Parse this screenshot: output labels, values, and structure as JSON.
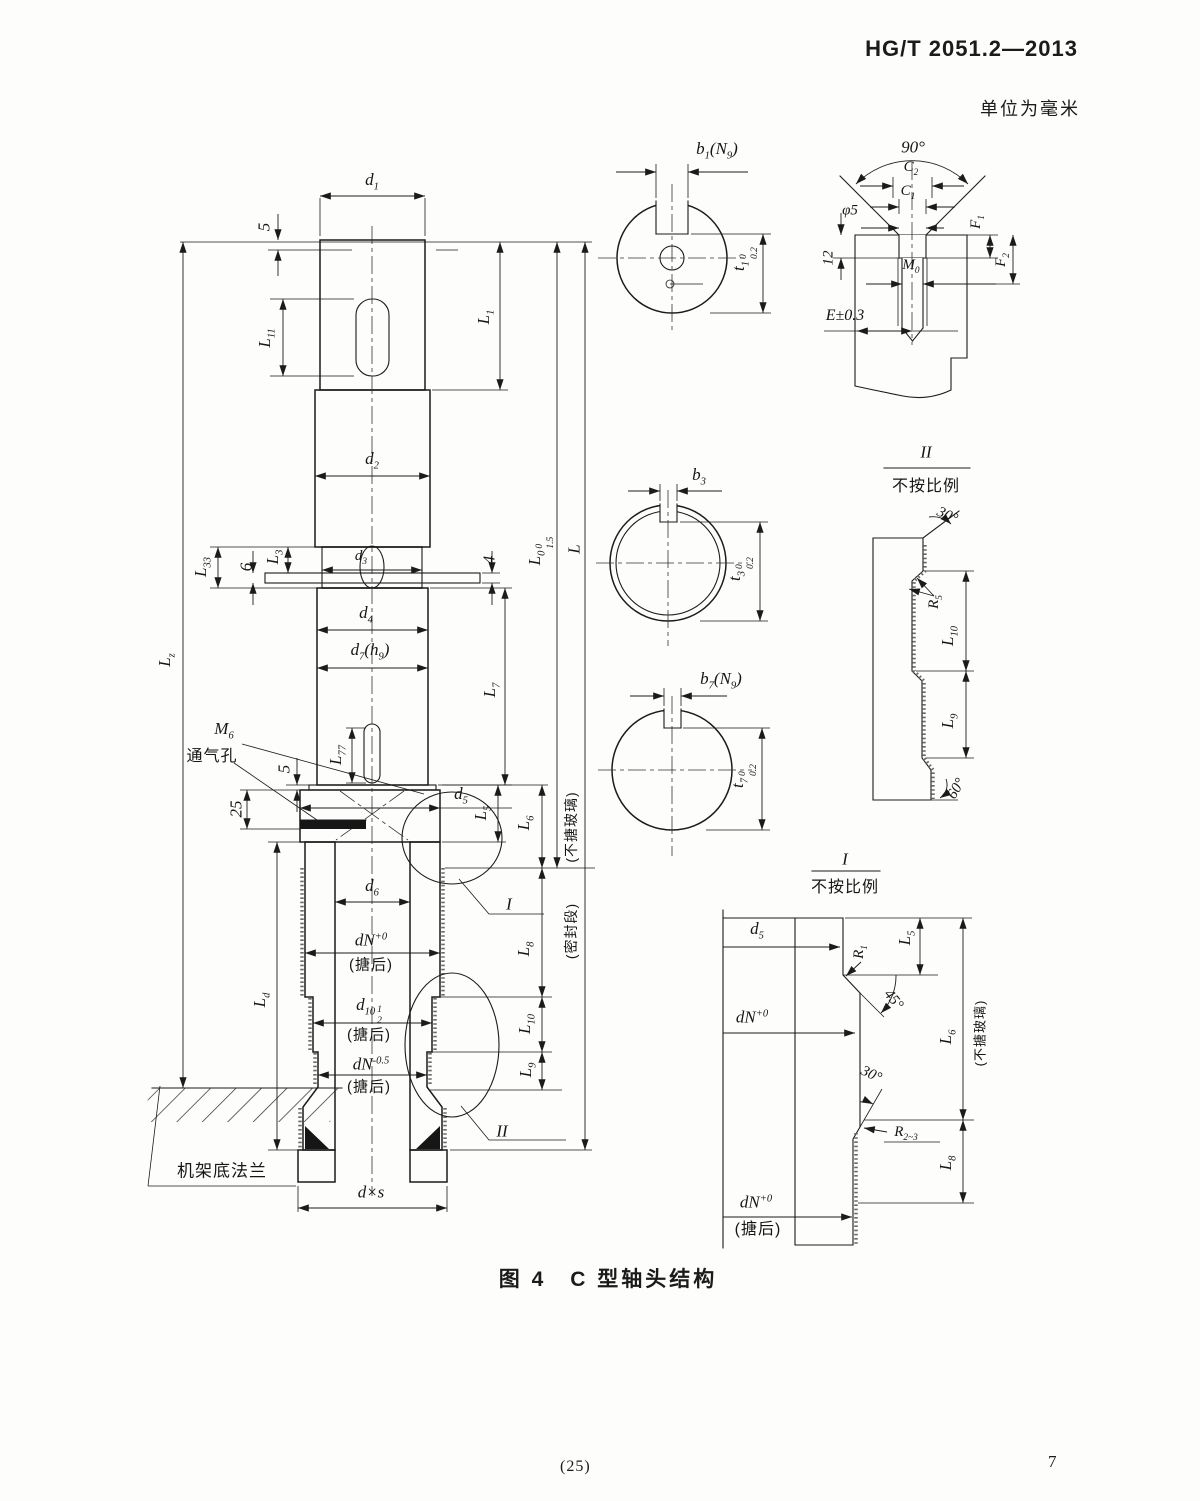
{
  "page": {
    "standard_code": "HG/T 2051.2—2013",
    "units_note": "单位为毫米",
    "figure_caption": "图 4　C 型轴头结构",
    "footer_center": "(25)",
    "footer_page": "7",
    "ink": "#1b1b1b",
    "paper": "#fdfdfb"
  },
  "labels": [
    {
      "name": "dim-d1",
      "x": 372,
      "y": 182,
      "rot": 0,
      "parts": [
        {
          "t": "d"
        },
        {
          "sub": "1"
        }
      ]
    },
    {
      "name": "dim-5-top",
      "x": 264,
      "y": 227,
      "rot": -90,
      "parts": [
        {
          "t": "5"
        }
      ]
    },
    {
      "name": "dim-L11",
      "x": 267,
      "y": 338,
      "rot": -90,
      "parts": [
        {
          "t": "L"
        },
        {
          "sub": "11"
        }
      ]
    },
    {
      "name": "dim-L1",
      "x": 486,
      "y": 317,
      "rot": -90,
      "parts": [
        {
          "t": "L"
        },
        {
          "sub": "1"
        }
      ]
    },
    {
      "name": "dim-d2",
      "x": 372,
      "y": 461,
      "rot": 0,
      "parts": [
        {
          "t": "d"
        },
        {
          "sub": "2"
        }
      ]
    },
    {
      "name": "dim-Lz",
      "x": 167,
      "y": 660,
      "rot": -90,
      "parts": [
        {
          "t": "L"
        },
        {
          "sub": "z"
        }
      ]
    },
    {
      "name": "dim-L33",
      "x": 203,
      "y": 567,
      "rot": -90,
      "parts": [
        {
          "t": "L"
        },
        {
          "sub": "33"
        }
      ]
    },
    {
      "name": "dim-6",
      "x": 246,
      "y": 567,
      "rot": -90,
      "parts": [
        {
          "t": "6"
        }
      ]
    },
    {
      "name": "dim-L3",
      "x": 275,
      "y": 557,
      "rot": -90,
      "parts": [
        {
          "t": "L"
        },
        {
          "sub": "3"
        }
      ]
    },
    {
      "name": "dim-d3",
      "x": 361,
      "y": 558,
      "rot": 0,
      "size": 15,
      "parts": [
        {
          "t": "d"
        },
        {
          "sub": "3"
        }
      ]
    },
    {
      "name": "dim-4",
      "x": 489,
      "y": 560,
      "rot": -90,
      "parts": [
        {
          "t": "4"
        }
      ]
    },
    {
      "name": "dim-d4",
      "x": 366,
      "y": 615,
      "rot": 0,
      "parts": [
        {
          "t": "d"
        },
        {
          "sub": "4"
        }
      ]
    },
    {
      "name": "dim-d7h9",
      "x": 370,
      "y": 652,
      "rot": 0,
      "parts": [
        {
          "t": "d"
        },
        {
          "sub": "7"
        },
        {
          "t": "(h"
        },
        {
          "sub": "9"
        },
        {
          "t": ")"
        }
      ]
    },
    {
      "name": "dim-L7",
      "x": 492,
      "y": 690,
      "rot": -90,
      "parts": [
        {
          "t": "L"
        },
        {
          "sub": "7"
        }
      ]
    },
    {
      "name": "dim-L0",
      "x": 541,
      "y": 551,
      "rot": -90,
      "parts": [
        {
          "t": "L"
        },
        {
          "sub": "0"
        },
        {
          "tol": [
            "0",
            "1.5"
          ]
        }
      ]
    },
    {
      "name": "dim-L-total",
      "x": 574,
      "y": 549,
      "rot": -90,
      "parts": [
        {
          "t": "L"
        }
      ]
    },
    {
      "name": "thread-M6",
      "x": 224,
      "y": 731,
      "rot": 0,
      "parts": [
        {
          "t": "M"
        },
        {
          "sub": "6"
        }
      ]
    },
    {
      "name": "vent-hole-note",
      "x": 212,
      "y": 757,
      "rot": 0,
      "size": 16,
      "cjk": true,
      "parts": [
        {
          "t": "通气孔"
        }
      ]
    },
    {
      "name": "dim-L77",
      "x": 338,
      "y": 755,
      "rot": -90,
      "parts": [
        {
          "t": "L"
        },
        {
          "sub": "77"
        }
      ]
    },
    {
      "name": "dim-5-flange",
      "x": 284,
      "y": 769,
      "rot": -90,
      "parts": [
        {
          "t": "5"
        }
      ]
    },
    {
      "name": "dim-25",
      "x": 236,
      "y": 809,
      "rot": -90,
      "parts": [
        {
          "t": "25"
        }
      ]
    },
    {
      "name": "dim-d5-main",
      "x": 461,
      "y": 796,
      "rot": 0,
      "parts": [
        {
          "t": "d"
        },
        {
          "sub": "5"
        }
      ]
    },
    {
      "name": "dim-L5-main",
      "x": 483,
      "y": 813,
      "rot": -90,
      "parts": [
        {
          "t": "L"
        },
        {
          "sub": "5"
        }
      ]
    },
    {
      "name": "dim-L6-main",
      "x": 526,
      "y": 823,
      "rot": -90,
      "parts": [
        {
          "t": "L"
        },
        {
          "sub": "6"
        }
      ]
    },
    {
      "name": "note-unglazed-main",
      "x": 571,
      "y": 827,
      "rot": -90,
      "size": 14,
      "cjk": true,
      "parts": [
        {
          "t": "(不搪玻璃)"
        }
      ]
    },
    {
      "name": "dim-d6",
      "x": 372,
      "y": 888,
      "rot": 0,
      "parts": [
        {
          "t": "d"
        },
        {
          "sub": "6"
        }
      ]
    },
    {
      "name": "dim-dN-main",
      "x": 371,
      "y": 940,
      "rot": 0,
      "parts": [
        {
          "t": "dN"
        },
        {
          "sup": "+0"
        }
      ]
    },
    {
      "name": "note-tanghou-1",
      "x": 371,
      "y": 965,
      "rot": 0,
      "size": 15,
      "cjk": true,
      "parts": [
        {
          "t": "(搪后)"
        }
      ]
    },
    {
      "name": "dim-L8-main",
      "x": 526,
      "y": 949,
      "rot": -90,
      "parts": [
        {
          "t": "L"
        },
        {
          "sub": "8"
        }
      ]
    },
    {
      "name": "note-seal-section",
      "x": 571,
      "y": 931,
      "rot": -90,
      "size": 14,
      "cjk": true,
      "parts": [
        {
          "t": "(密封段)"
        }
      ]
    },
    {
      "name": "detail-marker-I",
      "x": 509,
      "y": 904,
      "rot": 0,
      "parts": [
        {
          "t": "I"
        }
      ]
    },
    {
      "name": "dim-Ld",
      "x": 262,
      "y": 1000,
      "rot": -90,
      "parts": [
        {
          "t": "L"
        },
        {
          "sub": "d"
        }
      ]
    },
    {
      "name": "dim-d10",
      "x": 369,
      "y": 1011,
      "rot": 0,
      "parts": [
        {
          "t": "d"
        },
        {
          "sub": "10"
        },
        {
          "tol": [
            "1",
            "2"
          ]
        }
      ]
    },
    {
      "name": "note-tanghou-2",
      "x": 369,
      "y": 1035,
      "rot": 0,
      "size": 15,
      "cjk": true,
      "parts": [
        {
          "t": "(搪后)"
        }
      ]
    },
    {
      "name": "dim-dN-05",
      "x": 371,
      "y": 1064,
      "rot": 0,
      "parts": [
        {
          "t": "dN"
        },
        {
          "sup": "-0.5"
        }
      ]
    },
    {
      "name": "note-tanghou-3",
      "x": 369,
      "y": 1087,
      "rot": 0,
      "size": 15,
      "cjk": true,
      "parts": [
        {
          "t": "(搪后)"
        }
      ]
    },
    {
      "name": "dim-L10-main",
      "x": 527,
      "y": 1024,
      "rot": -90,
      "parts": [
        {
          "t": "L"
        },
        {
          "sub": "10"
        }
      ]
    },
    {
      "name": "dim-L9-main",
      "x": 528,
      "y": 1070,
      "rot": -90,
      "parts": [
        {
          "t": "L"
        },
        {
          "sub": "9"
        }
      ]
    },
    {
      "name": "detail-marker-II",
      "x": 502,
      "y": 1131,
      "rot": 0,
      "parts": [
        {
          "t": "II"
        }
      ]
    },
    {
      "name": "frame-flange-note",
      "x": 222,
      "y": 1171,
      "rot": 0,
      "size": 17,
      "cjk": true,
      "parts": [
        {
          "t": "机架底法兰"
        }
      ]
    },
    {
      "name": "dim-dxs",
      "x": 371,
      "y": 1192,
      "rot": 0,
      "parts": [
        {
          "t": "d×s"
        }
      ]
    },
    {
      "name": "dim-b1N9",
      "x": 717,
      "y": 151,
      "rot": 0,
      "parts": [
        {
          "t": "b"
        },
        {
          "sub": "1"
        },
        {
          "t": "(N"
        },
        {
          "sub": "9"
        },
        {
          "t": ")"
        }
      ]
    },
    {
      "name": "dim-t1",
      "x": 745,
      "y": 259,
      "rot": -90,
      "parts": [
        {
          "t": "t"
        },
        {
          "sub": "1"
        },
        {
          "tol": [
            "0",
            "0.2"
          ]
        }
      ]
    },
    {
      "name": "dim-b3",
      "x": 699,
      "y": 477,
      "rot": 0,
      "parts": [
        {
          "t": "b"
        },
        {
          "sub": "3"
        }
      ]
    },
    {
      "name": "dim-t3",
      "x": 741,
      "y": 569,
      "rot": -90,
      "parts": [
        {
          "t": "t"
        },
        {
          "sub": "3"
        },
        {
          "tol": [
            "0",
            "0.2"
          ]
        }
      ]
    },
    {
      "name": "dim-b7N9",
      "x": 721,
      "y": 681,
      "rot": 0,
      "parts": [
        {
          "t": "b"
        },
        {
          "sub": "7"
        },
        {
          "t": "(N"
        },
        {
          "sub": "9"
        },
        {
          "t": ")"
        }
      ]
    },
    {
      "name": "dim-t7",
      "x": 744,
      "y": 776,
      "rot": -90,
      "parts": [
        {
          "t": "t"
        },
        {
          "sub": "7"
        },
        {
          "tol": [
            "0",
            "0.2"
          ]
        }
      ]
    },
    {
      "name": "angle-90",
      "x": 913,
      "y": 147,
      "rot": 0,
      "parts": [
        {
          "t": "90°"
        }
      ]
    },
    {
      "name": "dim-C2",
      "x": 911,
      "y": 169,
      "rot": 0,
      "size": 15,
      "parts": [
        {
          "t": "C"
        },
        {
          "sub": "2"
        }
      ]
    },
    {
      "name": "dim-C1",
      "x": 908,
      "y": 193,
      "rot": 0,
      "size": 15,
      "parts": [
        {
          "t": "C"
        },
        {
          "sub": "1"
        }
      ]
    },
    {
      "name": "dim-phi5",
      "x": 850,
      "y": 211,
      "rot": 0,
      "size": 15,
      "parts": [
        {
          "t": "φ5"
        }
      ]
    },
    {
      "name": "dim-12",
      "x": 829,
      "y": 258,
      "rot": -90,
      "size": 15,
      "parts": [
        {
          "t": "12"
        }
      ]
    },
    {
      "name": "thread-M0",
      "x": 911,
      "y": 267,
      "rot": 0,
      "size": 15,
      "parts": [
        {
          "t": "M"
        },
        {
          "sub": "0"
        }
      ]
    },
    {
      "name": "dim-F1",
      "x": 978,
      "y": 222,
      "rot": -90,
      "size": 15,
      "parts": [
        {
          "t": "F"
        },
        {
          "sub": "1"
        }
      ]
    },
    {
      "name": "dim-F2",
      "x": 1003,
      "y": 260,
      "rot": -90,
      "size": 15,
      "parts": [
        {
          "t": "F"
        },
        {
          "sub": "2"
        }
      ]
    },
    {
      "name": "dim-E",
      "x": 845,
      "y": 316,
      "rot": 0,
      "size": 16,
      "parts": [
        {
          "t": "E±0.3"
        }
      ]
    },
    {
      "name": "detail-II-title",
      "x": 926,
      "y": 452,
      "rot": 0,
      "parts": [
        {
          "t": "II"
        }
      ]
    },
    {
      "name": "detail-II-scale-note",
      "x": 926,
      "y": 487,
      "rot": 0,
      "size": 16,
      "cjk": true,
      "parts": [
        {
          "t": "不按比例"
        }
      ]
    },
    {
      "name": "angle-30-detail-II",
      "x": 947,
      "y": 516,
      "rot": 25,
      "size": 15,
      "parts": [
        {
          "t": "30°"
        }
      ]
    },
    {
      "name": "dim-R5",
      "x": 936,
      "y": 602,
      "rot": -90,
      "size": 15,
      "parts": [
        {
          "t": "R"
        },
        {
          "sub": "5"
        }
      ]
    },
    {
      "name": "dim-L10-detail-II",
      "x": 950,
      "y": 636,
      "rot": -90,
      "parts": [
        {
          "t": "L"
        },
        {
          "sub": "10"
        }
      ]
    },
    {
      "name": "dim-L9-detail-II",
      "x": 950,
      "y": 721,
      "rot": -90,
      "parts": [
        {
          "t": "L"
        },
        {
          "sub": "9"
        }
      ]
    },
    {
      "name": "angle-60-detail-II",
      "x": 957,
      "y": 789,
      "rot": -60,
      "size": 15,
      "parts": [
        {
          "t": "60°"
        }
      ]
    },
    {
      "name": "detail-I-title",
      "x": 845,
      "y": 859,
      "rot": 0,
      "parts": [
        {
          "t": "I"
        }
      ]
    },
    {
      "name": "detail-I-scale-note",
      "x": 845,
      "y": 888,
      "rot": 0,
      "size": 16,
      "cjk": true,
      "parts": [
        {
          "t": "不按比例"
        }
      ]
    },
    {
      "name": "dim-d5-detail-I",
      "x": 757,
      "y": 931,
      "rot": 0,
      "parts": [
        {
          "t": "d"
        },
        {
          "sub": "5"
        }
      ]
    },
    {
      "name": "dim-R1",
      "x": 861,
      "y": 952,
      "rot": -90,
      "size": 15,
      "parts": [
        {
          "t": "R"
        },
        {
          "sub": "1"
        }
      ]
    },
    {
      "name": "dim-L5-detail-I",
      "x": 907,
      "y": 938,
      "rot": -90,
      "parts": [
        {
          "t": "L"
        },
        {
          "sub": "5"
        }
      ]
    },
    {
      "name": "angle-45-detail-I",
      "x": 893,
      "y": 1000,
      "rot": 50,
      "size": 15,
      "parts": [
        {
          "t": "45°"
        }
      ]
    },
    {
      "name": "dim-dN-detail-I-top",
      "x": 752,
      "y": 1017,
      "rot": 0,
      "parts": [
        {
          "t": "dN"
        },
        {
          "sup": "+0"
        }
      ]
    },
    {
      "name": "angle-30-detail-I",
      "x": 871,
      "y": 1075,
      "rot": 25,
      "size": 15,
      "parts": [
        {
          "t": "30°"
        }
      ]
    },
    {
      "name": "dim-R2-3",
      "x": 906,
      "y": 1134,
      "rot": 0,
      "size": 15,
      "parts": [
        {
          "t": "R"
        },
        {
          "sub": "2~3"
        }
      ]
    },
    {
      "name": "dim-L6-detail-I",
      "x": 948,
      "y": 1037,
      "rot": -90,
      "parts": [
        {
          "t": "L"
        },
        {
          "sub": "6"
        }
      ]
    },
    {
      "name": "note-unglazed-detail-I",
      "x": 980,
      "y": 1033,
      "rot": -90,
      "size": 13,
      "cjk": true,
      "parts": [
        {
          "t": "(不搪玻璃)"
        }
      ]
    },
    {
      "name": "dim-L8-detail-I",
      "x": 948,
      "y": 1163,
      "rot": -90,
      "parts": [
        {
          "t": "L"
        },
        {
          "sub": "8"
        }
      ]
    },
    {
      "name": "dim-dN-detail-I-bottom",
      "x": 756,
      "y": 1202,
      "rot": 0,
      "parts": [
        {
          "t": "dN"
        },
        {
          "sup": "+0"
        }
      ]
    },
    {
      "name": "note-tanghou-detail-I",
      "x": 758,
      "y": 1230,
      "rot": 0,
      "size": 16,
      "cjk": true,
      "parts": [
        {
          "t": "(搪后)"
        }
      ]
    }
  ]
}
